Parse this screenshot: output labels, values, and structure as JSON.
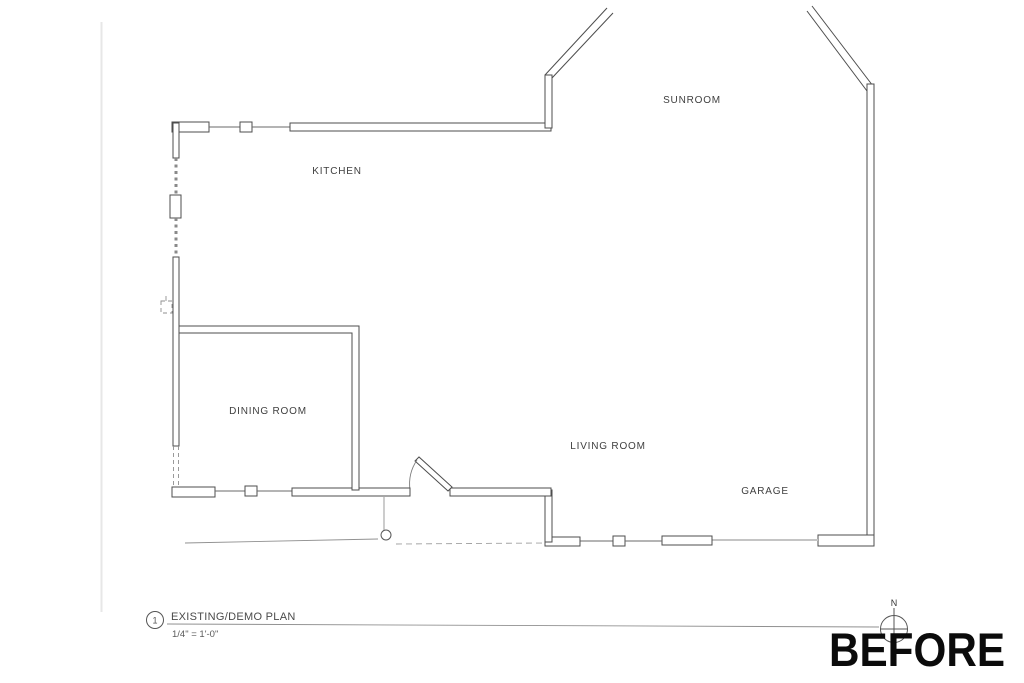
{
  "drawing": {
    "rooms": [
      {
        "id": "kitchen",
        "label": "KITCHEN"
      },
      {
        "id": "sunroom",
        "label": "SUNROOM"
      },
      {
        "id": "dining-room",
        "label": "DINING ROOM"
      },
      {
        "id": "living-room",
        "label": "LIVING ROOM"
      },
      {
        "id": "garage",
        "label": "GARAGE"
      }
    ],
    "title_block": {
      "detail_number": "1",
      "title": "EXISTING/DEMO PLAN",
      "scale": "1/4\" = 1'-0\""
    },
    "north_arrow": {
      "label": "N"
    },
    "stamp": {
      "text": "BEFORE"
    },
    "colors": {
      "wall": "#4d4d4d",
      "annotation_text": "#3f3f3f",
      "light_lines": "#999999",
      "garage_door_faint": "#c4c4c4",
      "stamp": "#0b0b0b",
      "background": "#ffffff"
    }
  }
}
